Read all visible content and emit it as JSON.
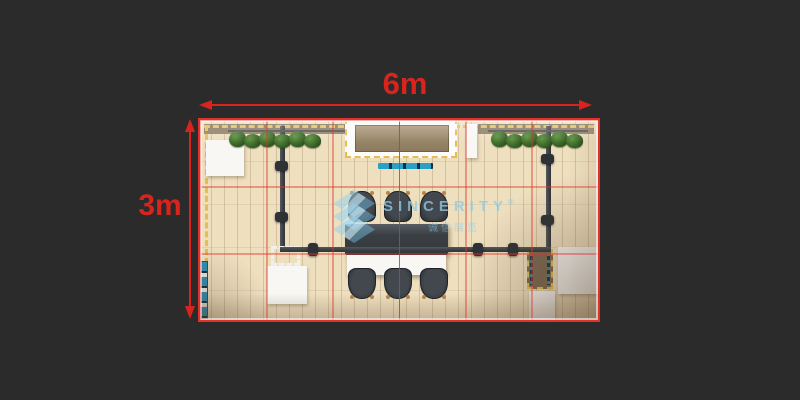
{
  "scene": {
    "background_color": "#2b2b2b",
    "annotation_color": "#d8241c"
  },
  "dimensions": {
    "width_label": "6m",
    "height_label": "3m"
  },
  "floorplan": {
    "grid": {
      "columns": 6,
      "rows": 3,
      "cell_size_m": 1,
      "line_color": "#e03228"
    },
    "floor_color": "#eedfbf",
    "dashed_trim_color": "#e6bd52",
    "truss_color": "#3c4044",
    "plant_color": "#3e6f2b",
    "accent_blue": "#2aa0c6",
    "furniture_white": "#f8f7f4",
    "chair_count": 6
  },
  "watermark": {
    "text": "SINCERITY",
    "registered_mark": "®",
    "subtext": "诚信展览",
    "color": "#8ecbe4"
  }
}
